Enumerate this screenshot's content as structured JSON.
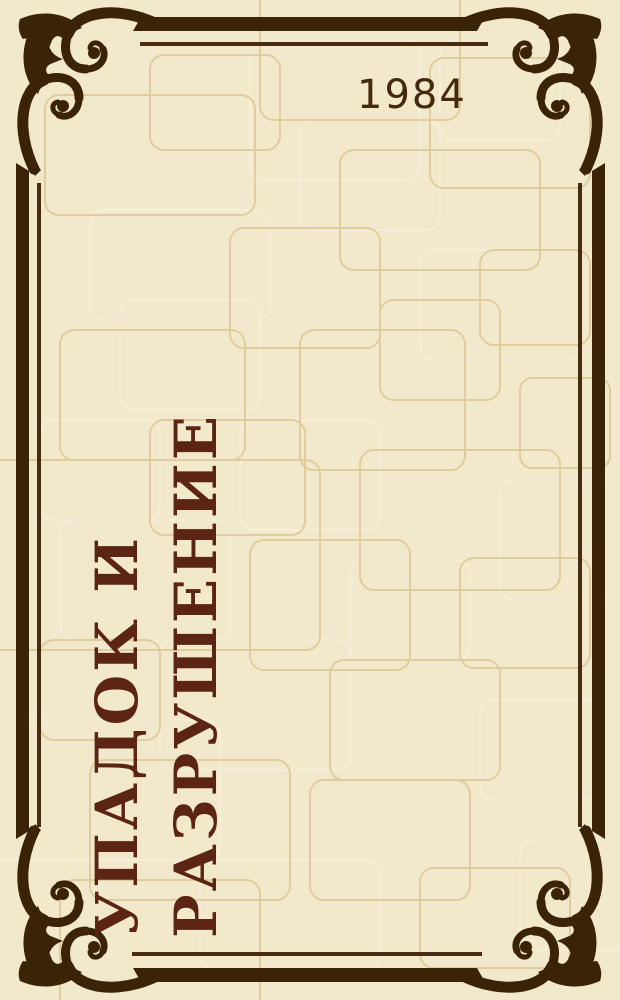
{
  "cover": {
    "year": "1984",
    "title_line1": "УПАДОК И",
    "title_line2": "РАЗРУШЕНИЕ",
    "title_full": "УПАДОК И РАЗРУШЕНИЕ"
  },
  "ornament": {
    "name": "corner-scroll-ornament",
    "corners": [
      "top-left",
      "top-right",
      "bottom-left",
      "bottom-right"
    ]
  },
  "colors": {
    "background": "#f2e8cb",
    "pattern_line_dark": "#e0cd9d",
    "pattern_line_light": "#f6eed8",
    "frame": "#3a2306",
    "frame_thin_line": "#482b10",
    "title_text": "#5b2413",
    "year_text": "#45290f"
  }
}
